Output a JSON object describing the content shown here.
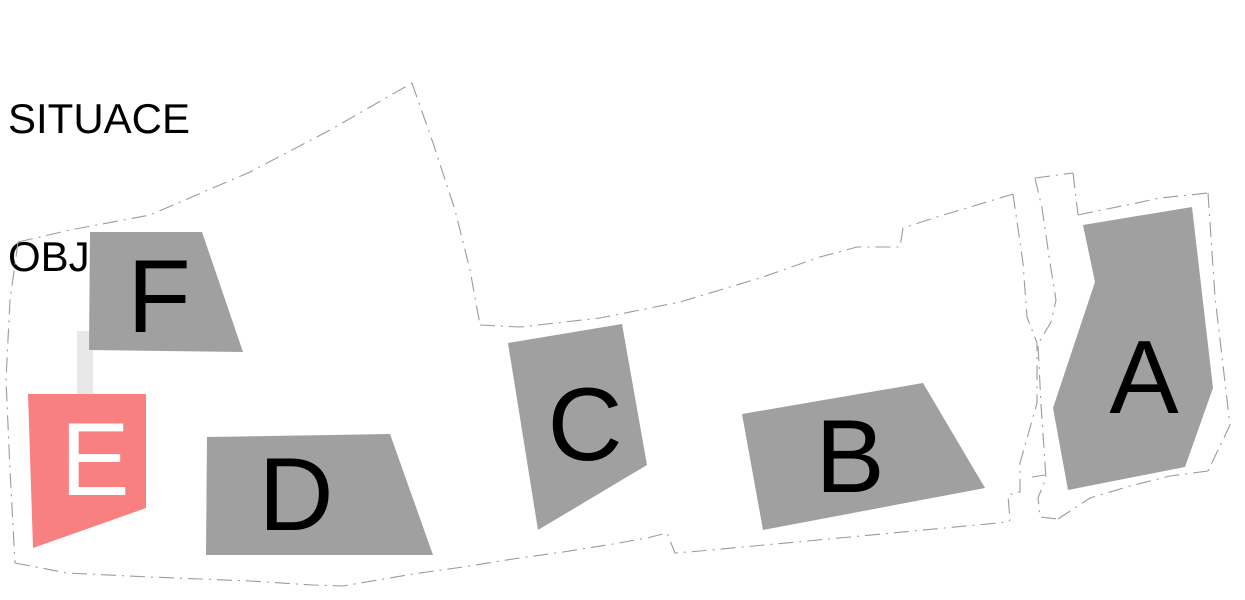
{
  "title": {
    "line1": "SITUACE",
    "line2": "OBJEKTY"
  },
  "colors": {
    "background": "#ffffff",
    "building_gray": "#a0a0a0",
    "highlight_red": "#f98080",
    "connector_gray": "#e8e8e8",
    "boundary_gray": "#9c9c9c",
    "label_black": "#000000",
    "label_white": "#ffffff"
  },
  "plan": {
    "width": 1245,
    "height": 600,
    "connector": {
      "x": 77,
      "y": 331,
      "w": 16,
      "h": 64
    },
    "buildings": [
      {
        "id": "F",
        "label": "F",
        "fill": "building_gray",
        "text_color": "label_black",
        "points": [
          [
            90,
            232
          ],
          [
            202,
            232
          ],
          [
            243,
            352
          ],
          [
            89,
            350
          ]
        ],
        "label_pos": [
          159,
          332
        ]
      },
      {
        "id": "E",
        "label": "E",
        "fill": "highlight_red",
        "text_color": "label_white",
        "points": [
          [
            28,
            394
          ],
          [
            146,
            394
          ],
          [
            146,
            508
          ],
          [
            33,
            548
          ]
        ],
        "label_pos": [
          95,
          495
        ]
      },
      {
        "id": "D",
        "label": "D",
        "fill": "building_gray",
        "text_color": "label_black",
        "points": [
          [
            207,
            437
          ],
          [
            390,
            434
          ],
          [
            433,
            555
          ],
          [
            206,
            555
          ]
        ],
        "label_pos": [
          296,
          530
        ]
      },
      {
        "id": "C",
        "label": "C",
        "fill": "building_gray",
        "text_color": "label_black",
        "points": [
          [
            508,
            343
          ],
          [
            622,
            324
          ],
          [
            647,
            465
          ],
          [
            538,
            530
          ]
        ],
        "label_pos": [
          585,
          460
        ]
      },
      {
        "id": "B",
        "label": "B",
        "fill": "building_gray",
        "text_color": "label_black",
        "points": [
          [
            742,
            414
          ],
          [
            923,
            383
          ],
          [
            985,
            488
          ],
          [
            763,
            530
          ]
        ],
        "label_pos": [
          850,
          492
        ]
      },
      {
        "id": "A",
        "label": "A",
        "fill": "building_gray",
        "text_color": "label_black",
        "points": [
          [
            1083,
            225
          ],
          [
            1192,
            207
          ],
          [
            1213,
            388
          ],
          [
            1185,
            467
          ],
          [
            1068,
            490
          ],
          [
            1053,
            408
          ],
          [
            1095,
            282
          ]
        ],
        "label_pos": [
          1144,
          413
        ]
      }
    ],
    "boundaries": [
      {
        "name": "outer-top-left",
        "points": [
          [
            18,
            242
          ],
          [
            70,
            230
          ],
          [
            150,
            215
          ],
          [
            250,
            172
          ],
          [
            330,
            130
          ],
          [
            412,
            83
          ]
        ]
      },
      {
        "name": "parcel-divider",
        "points": [
          [
            412,
            83
          ],
          [
            433,
            143
          ],
          [
            455,
            210
          ],
          [
            470,
            270
          ],
          [
            480,
            325
          ]
        ]
      },
      {
        "name": "middle-parcel-top",
        "points": [
          [
            480,
            325
          ],
          [
            520,
            327
          ],
          [
            600,
            318
          ],
          [
            680,
            302
          ],
          [
            760,
            278
          ],
          [
            820,
            257
          ],
          [
            857,
            247
          ],
          [
            900,
            247
          ],
          [
            903,
            228
          ],
          [
            940,
            216
          ],
          [
            977,
            205
          ],
          [
            1013,
            194
          ]
        ]
      },
      {
        "name": "middle-parcel-right",
        "points": [
          [
            1013,
            194
          ],
          [
            1023,
            263
          ],
          [
            1027,
            317
          ],
          [
            1037,
            343
          ],
          [
            1037,
            403
          ],
          [
            1020,
            463
          ],
          [
            1020,
            492
          ],
          [
            1008,
            495
          ],
          [
            1010,
            520
          ]
        ]
      },
      {
        "name": "outer-bottom",
        "points": [
          [
            15,
            563
          ],
          [
            67,
            573
          ],
          [
            150,
            577
          ],
          [
            250,
            581
          ],
          [
            313,
            585
          ],
          [
            343,
            586
          ],
          [
            413,
            574
          ],
          [
            463,
            567
          ],
          [
            513,
            559
          ],
          [
            563,
            552
          ],
          [
            613,
            544
          ],
          [
            647,
            538
          ],
          [
            667,
            533
          ],
          [
            675,
            553
          ],
          [
            700,
            551
          ],
          [
            850,
            537
          ],
          [
            1008,
            522
          ],
          [
            1010,
            520
          ]
        ]
      },
      {
        "name": "outer-left",
        "points": [
          [
            18,
            242
          ],
          [
            10,
            300
          ],
          [
            6,
            380
          ],
          [
            10,
            470
          ],
          [
            15,
            563
          ]
        ]
      },
      {
        "name": "corridor-left",
        "points": [
          [
            1035,
            178
          ],
          [
            1042,
            208
          ],
          [
            1050,
            263
          ],
          [
            1056,
            300
          ],
          [
            1051,
            322
          ],
          [
            1038,
            344
          ],
          [
            1041,
            405
          ],
          [
            1046,
            478
          ],
          [
            1038,
            498
          ],
          [
            1040,
            517
          ],
          [
            1058,
            519
          ]
        ]
      },
      {
        "name": "corridor-cap",
        "points": [
          [
            1035,
            178
          ],
          [
            1073,
            173
          ]
        ]
      },
      {
        "name": "corridor-right",
        "points": [
          [
            1073,
            173
          ],
          [
            1078,
            215
          ]
        ]
      },
      {
        "name": "parcel-a-top",
        "points": [
          [
            1078,
            215
          ],
          [
            1097,
            211
          ],
          [
            1127,
            205
          ],
          [
            1160,
            198
          ],
          [
            1208,
            193
          ]
        ]
      },
      {
        "name": "parcel-a-right",
        "points": [
          [
            1208,
            193
          ],
          [
            1215,
            297
          ],
          [
            1230,
            425
          ],
          [
            1208,
            471
          ]
        ]
      },
      {
        "name": "parcel-a-bottom",
        "points": [
          [
            1208,
            471
          ],
          [
            1170,
            476
          ],
          [
            1130,
            486
          ],
          [
            1090,
            498
          ],
          [
            1058,
            519
          ]
        ]
      },
      {
        "name": "corner-tick",
        "points": [
          [
            1032,
            477
          ],
          [
            1045,
            475
          ]
        ]
      }
    ]
  }
}
